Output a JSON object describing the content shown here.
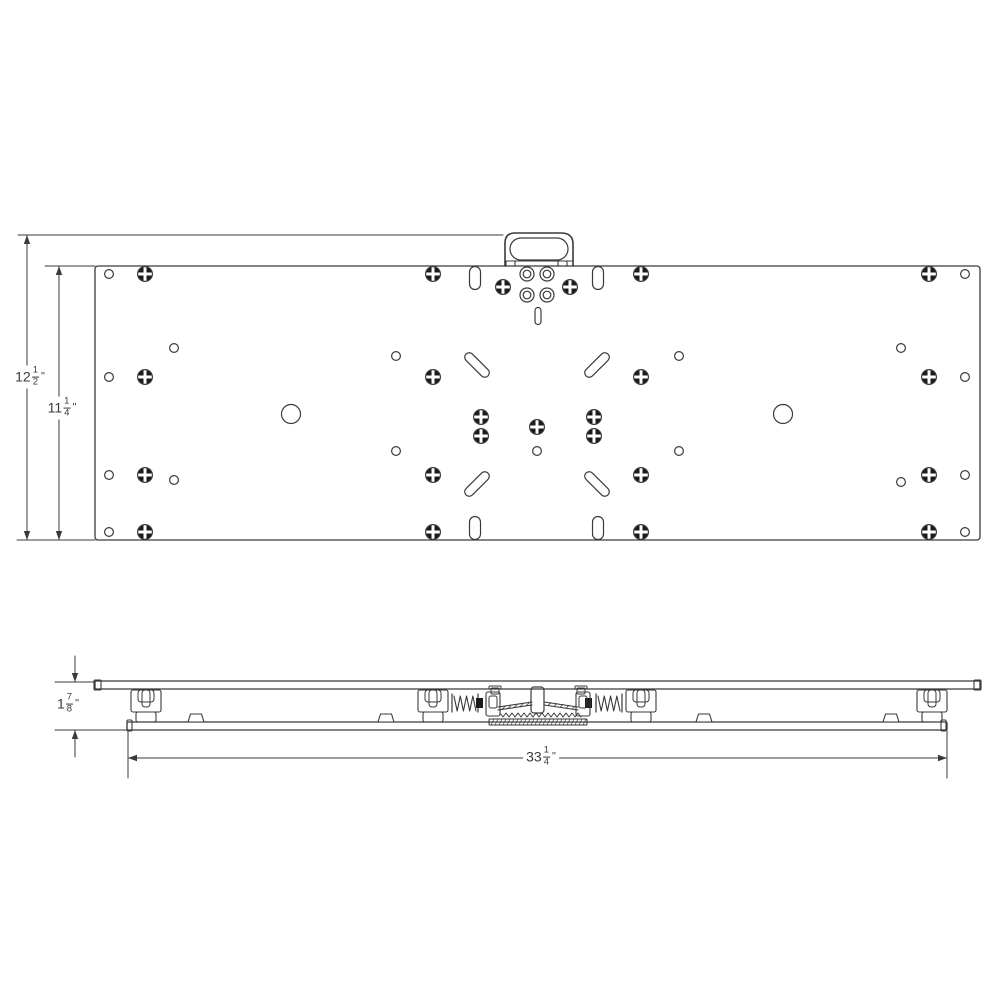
{
  "colors": {
    "line": "#3a3a3a",
    "screw_fill": "#1b1b1b",
    "background": "#ffffff"
  },
  "dimensions": {
    "overall_height": {
      "whole": "12",
      "num": "1",
      "den": "2",
      "unit": "\""
    },
    "plate_height": {
      "whole": "11",
      "num": "1",
      "den": "4",
      "unit": "\""
    },
    "side_height": {
      "whole": "1",
      "num": "7",
      "den": "8",
      "unit": "\""
    },
    "overall_width": {
      "whole": "33",
      "num": "1",
      "den": "4",
      "unit": "\""
    }
  },
  "geometry": {
    "top_view": {
      "plate": {
        "x": 95,
        "y": 266,
        "w": 885,
        "h": 274,
        "rx": 3
      },
      "handle": {
        "outer": "M505,266 L505,243 Q505,233 515,233 L561,233 Q573,233 573,244 L573,266",
        "inner": {
          "x": 510,
          "y": 238,
          "w": 58,
          "h": 22,
          "rx": 11
        },
        "collar_y": 261,
        "tabs": [
          [
            506,
            261,
            9,
            5
          ],
          [
            558,
            261,
            9,
            5
          ]
        ]
      },
      "screws": {
        "r": 7.4,
        "pts": [
          [
            145,
            274
          ],
          [
            433,
            274
          ],
          [
            641,
            274
          ],
          [
            929,
            274
          ],
          [
            145,
            377
          ],
          [
            433,
            377
          ],
          [
            641,
            377
          ],
          [
            929,
            377
          ],
          [
            145,
            475
          ],
          [
            433,
            475
          ],
          [
            641,
            475
          ],
          [
            929,
            475
          ],
          [
            145,
            532
          ],
          [
            433,
            532
          ],
          [
            641,
            532
          ],
          [
            929,
            532
          ],
          [
            503,
            287
          ],
          [
            570,
            287
          ],
          [
            481,
            417
          ],
          [
            481,
            436
          ],
          [
            594,
            417
          ],
          [
            594,
            436
          ],
          [
            537,
            427
          ]
        ]
      },
      "small_holes": {
        "r": 4.4,
        "pts": [
          [
            109,
            274
          ],
          [
            109,
            377
          ],
          [
            109,
            475
          ],
          [
            109,
            532
          ],
          [
            965,
            274
          ],
          [
            965,
            377
          ],
          [
            965,
            475
          ],
          [
            965,
            532
          ],
          [
            174,
            348
          ],
          [
            174,
            480
          ],
          [
            901,
            348
          ],
          [
            901,
            482
          ],
          [
            396,
            356
          ],
          [
            396,
            451
          ],
          [
            679,
            356
          ],
          [
            679,
            451
          ],
          [
            537,
            451
          ]
        ]
      },
      "rings": {
        "r_outer": 7,
        "r_inner": 3.8,
        "pts": [
          [
            527,
            274
          ],
          [
            547,
            274
          ],
          [
            527,
            295
          ],
          [
            547,
            295
          ]
        ]
      },
      "large_holes": {
        "r": 9.5,
        "pts": [
          [
            291,
            414
          ],
          [
            783,
            414
          ]
        ]
      },
      "v_slots": {
        "w": 11,
        "h": 23,
        "pts": [
          [
            475,
            278
          ],
          [
            598,
            278
          ],
          [
            475,
            528
          ],
          [
            598,
            528
          ]
        ]
      },
      "center_slot": {
        "w": 6,
        "h": 17,
        "pts": [
          [
            538,
            316
          ]
        ]
      },
      "diag_slots": {
        "len": 31,
        "w": 9,
        "items": [
          [
            477,
            365,
            45
          ],
          [
            597,
            365,
            -45
          ],
          [
            477,
            484,
            -45
          ],
          [
            597,
            484,
            45
          ]
        ]
      }
    },
    "side_view": {
      "top_bar": [
        95,
        681,
        885,
        8
      ],
      "end_caps": [
        [
          94,
          680,
          7,
          10
        ],
        [
          974,
          680,
          7,
          10
        ]
      ],
      "bottom_bar": [
        127,
        722,
        820,
        8
      ],
      "rail_caps": [
        [
          127,
          720,
          5,
          11
        ],
        [
          941,
          720,
          5,
          11
        ]
      ],
      "trucks": [
        146,
        433,
        641,
        932
      ],
      "springs": [
        {
          "x1": 452,
          "x2": 478,
          "block": 479,
          "dir": 1
        },
        {
          "x1": 596,
          "x2": 622,
          "block": 588,
          "dir": -1
        }
      ],
      "bumps": [
        196,
        386,
        704,
        891
      ],
      "center": {
        "post": [
          531,
          687,
          13,
          26
        ],
        "arms": [
          [
            486,
            692,
            14,
            24
          ],
          [
            576,
            692,
            14,
            24
          ]
        ],
        "pins": [
          [
            491,
            688,
            8,
            6
          ],
          [
            577,
            688,
            8,
            6
          ]
        ],
        "caps": [
          [
            489,
            686,
            12,
            3
          ],
          [
            575,
            686,
            12,
            3
          ]
        ],
        "leafs": [
          [
            498,
            700,
            34,
            1
          ],
          [
            544,
            700,
            34,
            -1
          ]
        ],
        "serr": [
          500,
          578,
          713
        ],
        "base": [
          489,
          719,
          98,
          6
        ]
      }
    },
    "dims": {
      "ext": [
        [
          18,
          235,
          503,
          235
        ],
        [
          45,
          266,
          95,
          266
        ],
        [
          17,
          540,
          95,
          540
        ],
        [
          55,
          682,
          95,
          682
        ],
        [
          55,
          730,
          127,
          730
        ],
        [
          128,
          732,
          128,
          778
        ],
        [
          947,
          731,
          947,
          778
        ]
      ],
      "v": [
        {
          "x": 27,
          "y1": 235,
          "y2": 540
        },
        {
          "x": 59,
          "y1": 266,
          "y2": 540
        }
      ],
      "small_v": {
        "x": 75,
        "seg1": [
          656,
          682
        ],
        "seg2": [
          757,
          730
        ]
      },
      "h": {
        "y": 758,
        "x1": 128,
        "x2": 947
      }
    }
  }
}
